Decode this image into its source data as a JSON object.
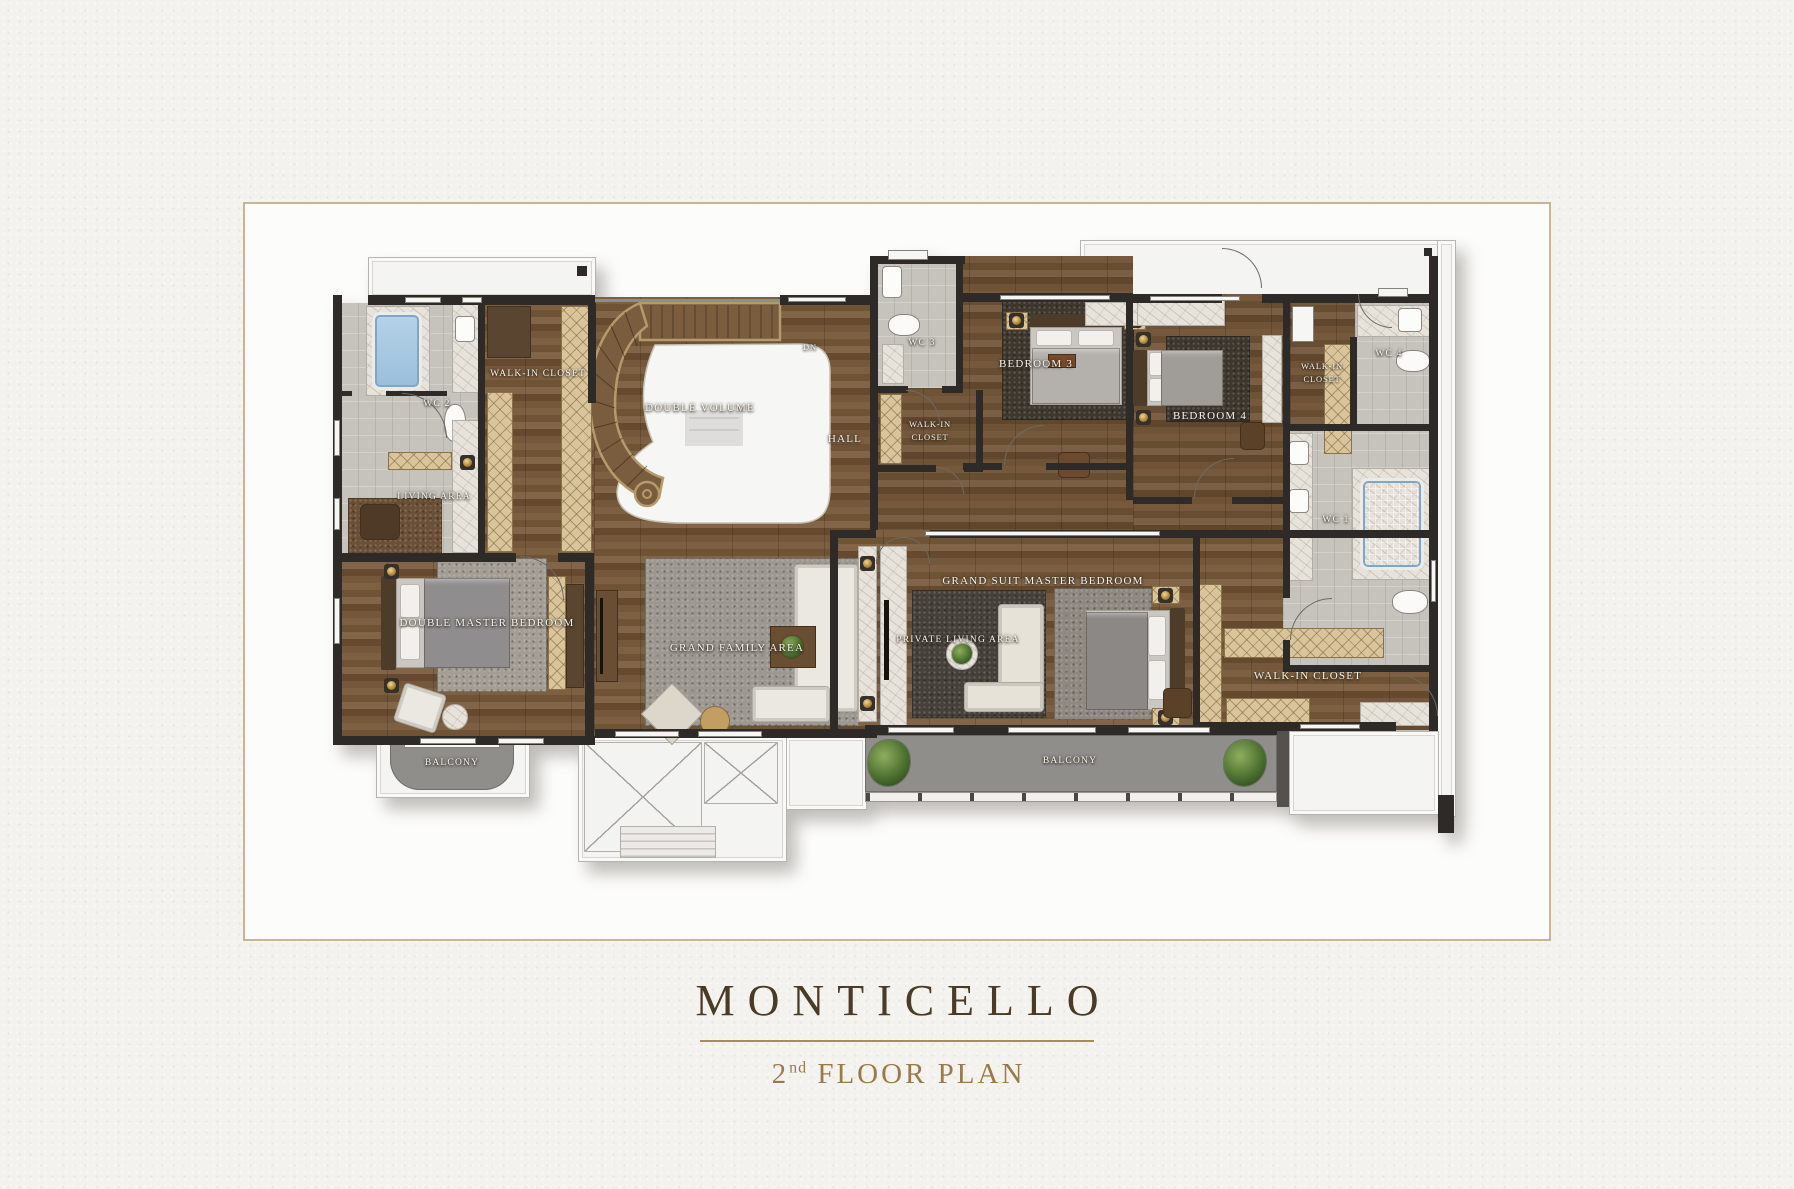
{
  "title": {
    "name": "MONTICELLO",
    "floor_number": "2",
    "floor_suffix": "nd",
    "floor_text": "FLOOR PLAN"
  },
  "palette": {
    "frame_border": "#c9b496",
    "title_text": "#4a3a26",
    "subtitle_text": "#9b7a49",
    "divider": "#a98d5b",
    "wall": "#2d2a27",
    "wood_floor": "#6f5438",
    "bath_tile": "#c6c2bc",
    "terrace_white": "#f4f4f2",
    "balcony_gray": "#8f8e8b",
    "water_blue": "#a8c8e2",
    "gold_accent": "#c8a24e"
  },
  "rooms": {
    "wc2": "WC 2",
    "walk_in_closet_master": "WALK-IN CLOSET",
    "double_volume": "DOUBLE VOLUME",
    "stairs_dn": "DN",
    "hall": "HALL",
    "wc3": "WC 3",
    "closet_b3_line1": "WALK-IN",
    "closet_b3_line2": "CLOSET",
    "bedroom3": "BEDROOM 3",
    "bedroom4": "BEDROOM 4",
    "closet_b4_line1": "WALK-IN",
    "closet_b4_line2": "CLOSET",
    "wc4": "WC 4",
    "wc1": "WC 1",
    "living_area": "LIVING AREA",
    "double_master_bedroom": "DOUBLE MASTER BEDROOM",
    "grand_family_area": "GRAND FAMILY AREA",
    "grand_suite_master_bedroom": "GRAND SUIT MASTER BEDROOM",
    "private_living_area": "PRIVATE LIVING AREA",
    "walk_in_closet_suite": "WALK-IN CLOSET",
    "balcony_left": "BALCONY",
    "balcony_main": "BALCONY"
  }
}
